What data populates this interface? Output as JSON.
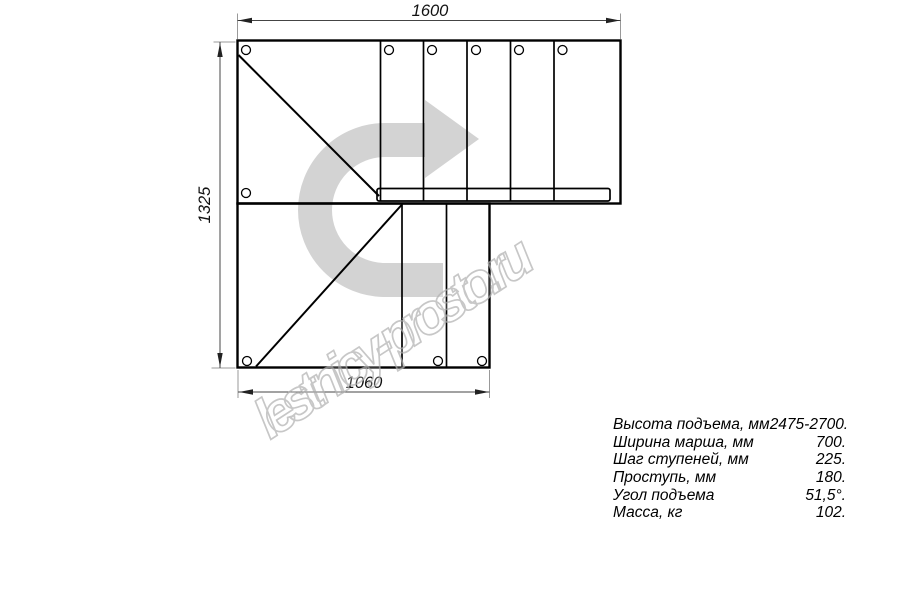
{
  "drawing": {
    "title_hint": "stair plan top view",
    "dimensions": {
      "top": "1600",
      "left": "1325",
      "bottom": "1060"
    },
    "watermark": "lestnicy-prosto.ru",
    "colors": {
      "line": "#000000",
      "dimension_line": "#444444",
      "extension_line": "#999999",
      "direction_arrow": "#d3d3d3",
      "watermark_outline": "#b2b2b2"
    }
  },
  "specs": {
    "rows": [
      {
        "label": "Высота подъема, мм",
        "value": "2475-2700."
      },
      {
        "label": "Ширина марша, мм",
        "value": "700."
      },
      {
        "label": "Шаг ступеней, мм",
        "value": "225."
      },
      {
        "label": "Проступь, мм",
        "value": "180."
      },
      {
        "label": "Угол подъема",
        "value": "51,5°."
      },
      {
        "label": "Масса, кг",
        "value": "102."
      }
    ]
  }
}
